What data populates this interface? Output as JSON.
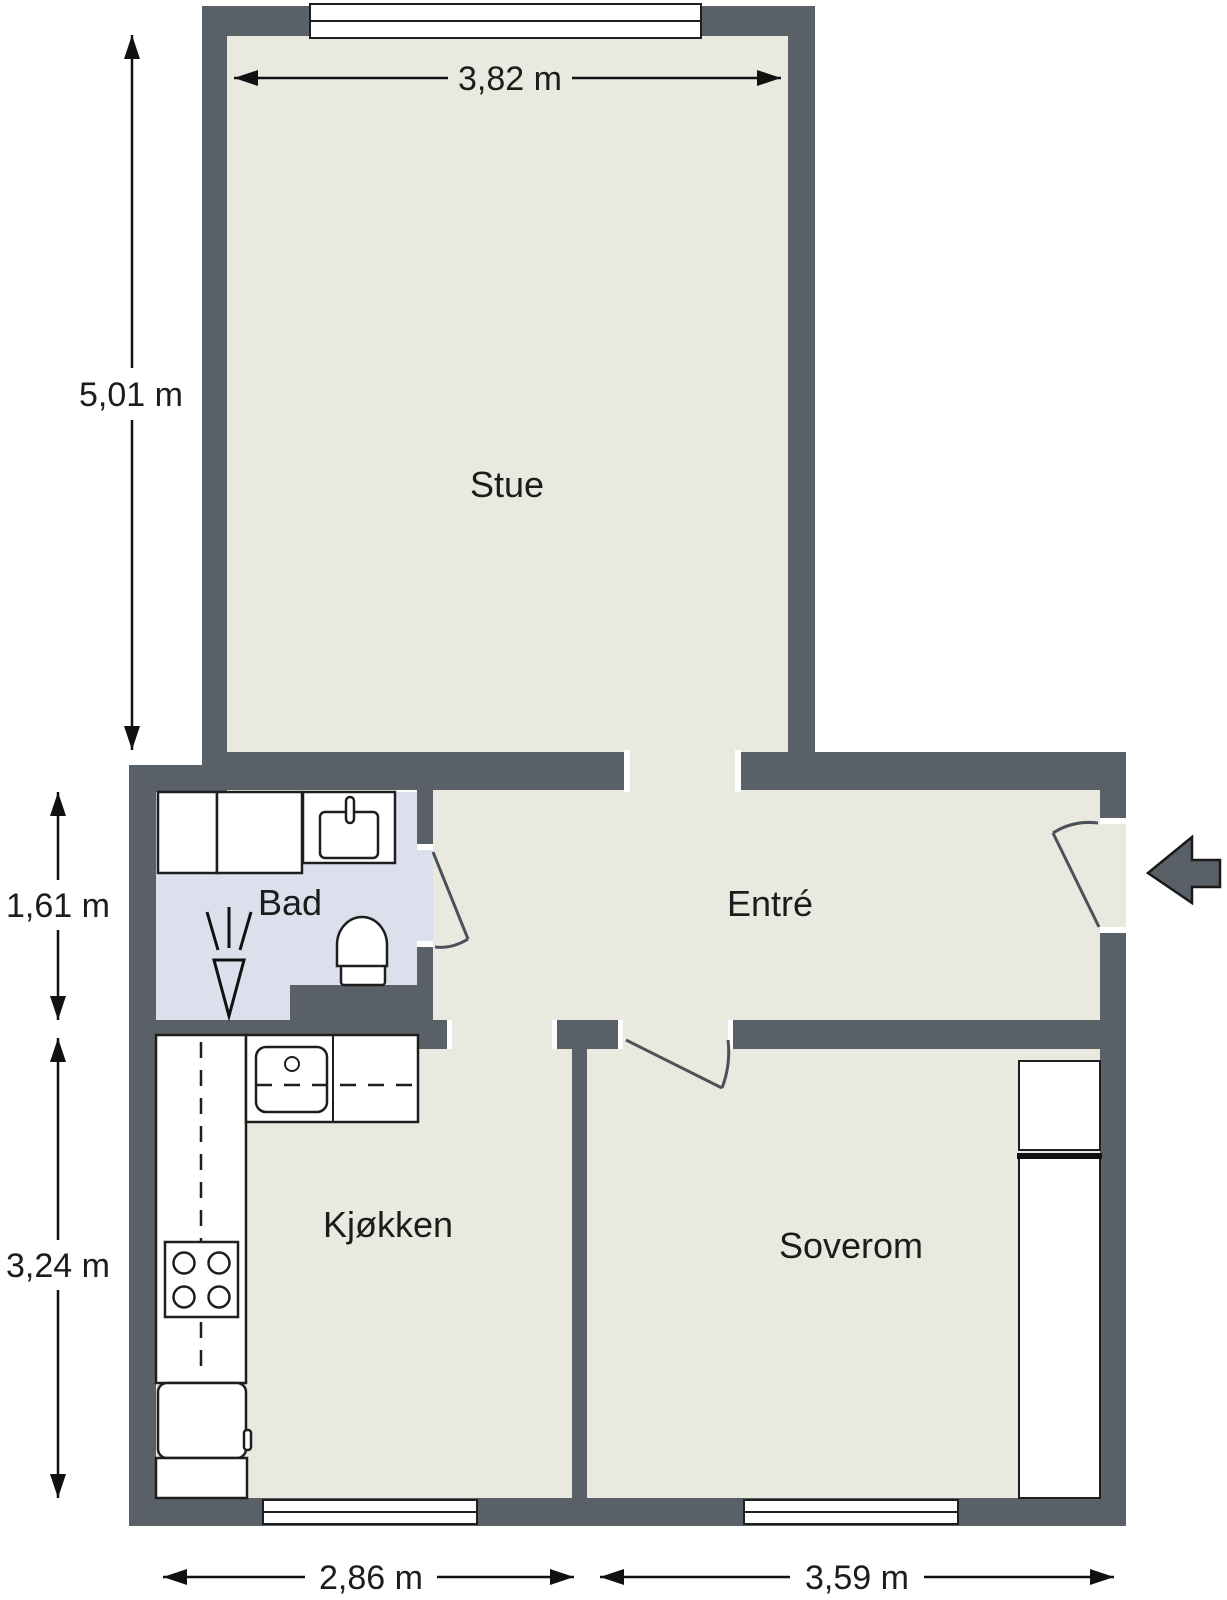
{
  "plan": {
    "type": "apartment-floor-plan",
    "rooms": [
      {
        "id": "stue",
        "label": "Stue"
      },
      {
        "id": "bad",
        "label": "Bad"
      },
      {
        "id": "entre",
        "label": "Entré"
      },
      {
        "id": "kjokken",
        "label": "Kjøkken"
      },
      {
        "id": "soverom",
        "label": "Soverom"
      }
    ],
    "dimensions": {
      "stue_width": "3,82 m",
      "stue_height": "5,01 m",
      "bad_height": "1,61 m",
      "kitchen_height": "3,24 m",
      "kitchen_width": "2,86 m",
      "bedroom_width": "3,59 m"
    },
    "colors": {
      "wall": "#5a6067",
      "floor": "#eae9e0",
      "bathroom_floor": "#dbe0ec",
      "fixture": "#ffffff",
      "outline": "#1e1e1e",
      "dimension": "#111111"
    },
    "icons": [
      "entry-arrow-icon",
      "window-icon",
      "door-swing-icon",
      "toilet-icon",
      "bathroom-sink-icon",
      "shower-symbol-icon",
      "kitchen-sink-icon",
      "stove-icon",
      "fridge-icon",
      "wardrobe-icon",
      "dimension-arrow-icon"
    ]
  }
}
